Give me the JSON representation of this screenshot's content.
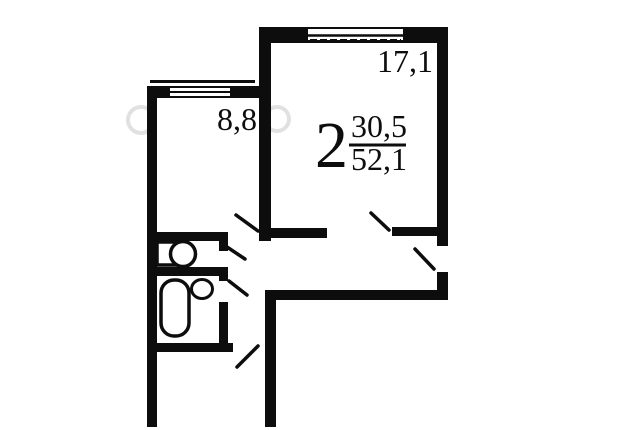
{
  "apartment": {
    "rooms_count": "2",
    "living_area": "30,5",
    "total_area": "52,1"
  },
  "room_labels": {
    "living_room": "17,1",
    "kitchen": "8,8"
  },
  "colors": {
    "wall": "#0d0d0d",
    "background": "#ffffff",
    "watermark": "#bcbcbc"
  },
  "icons": {
    "window": "window-icon",
    "door": "door-leaf-icon",
    "toilet": "toilet-icon",
    "bathtub": "bathtub-icon",
    "sink": "sink-icon"
  }
}
